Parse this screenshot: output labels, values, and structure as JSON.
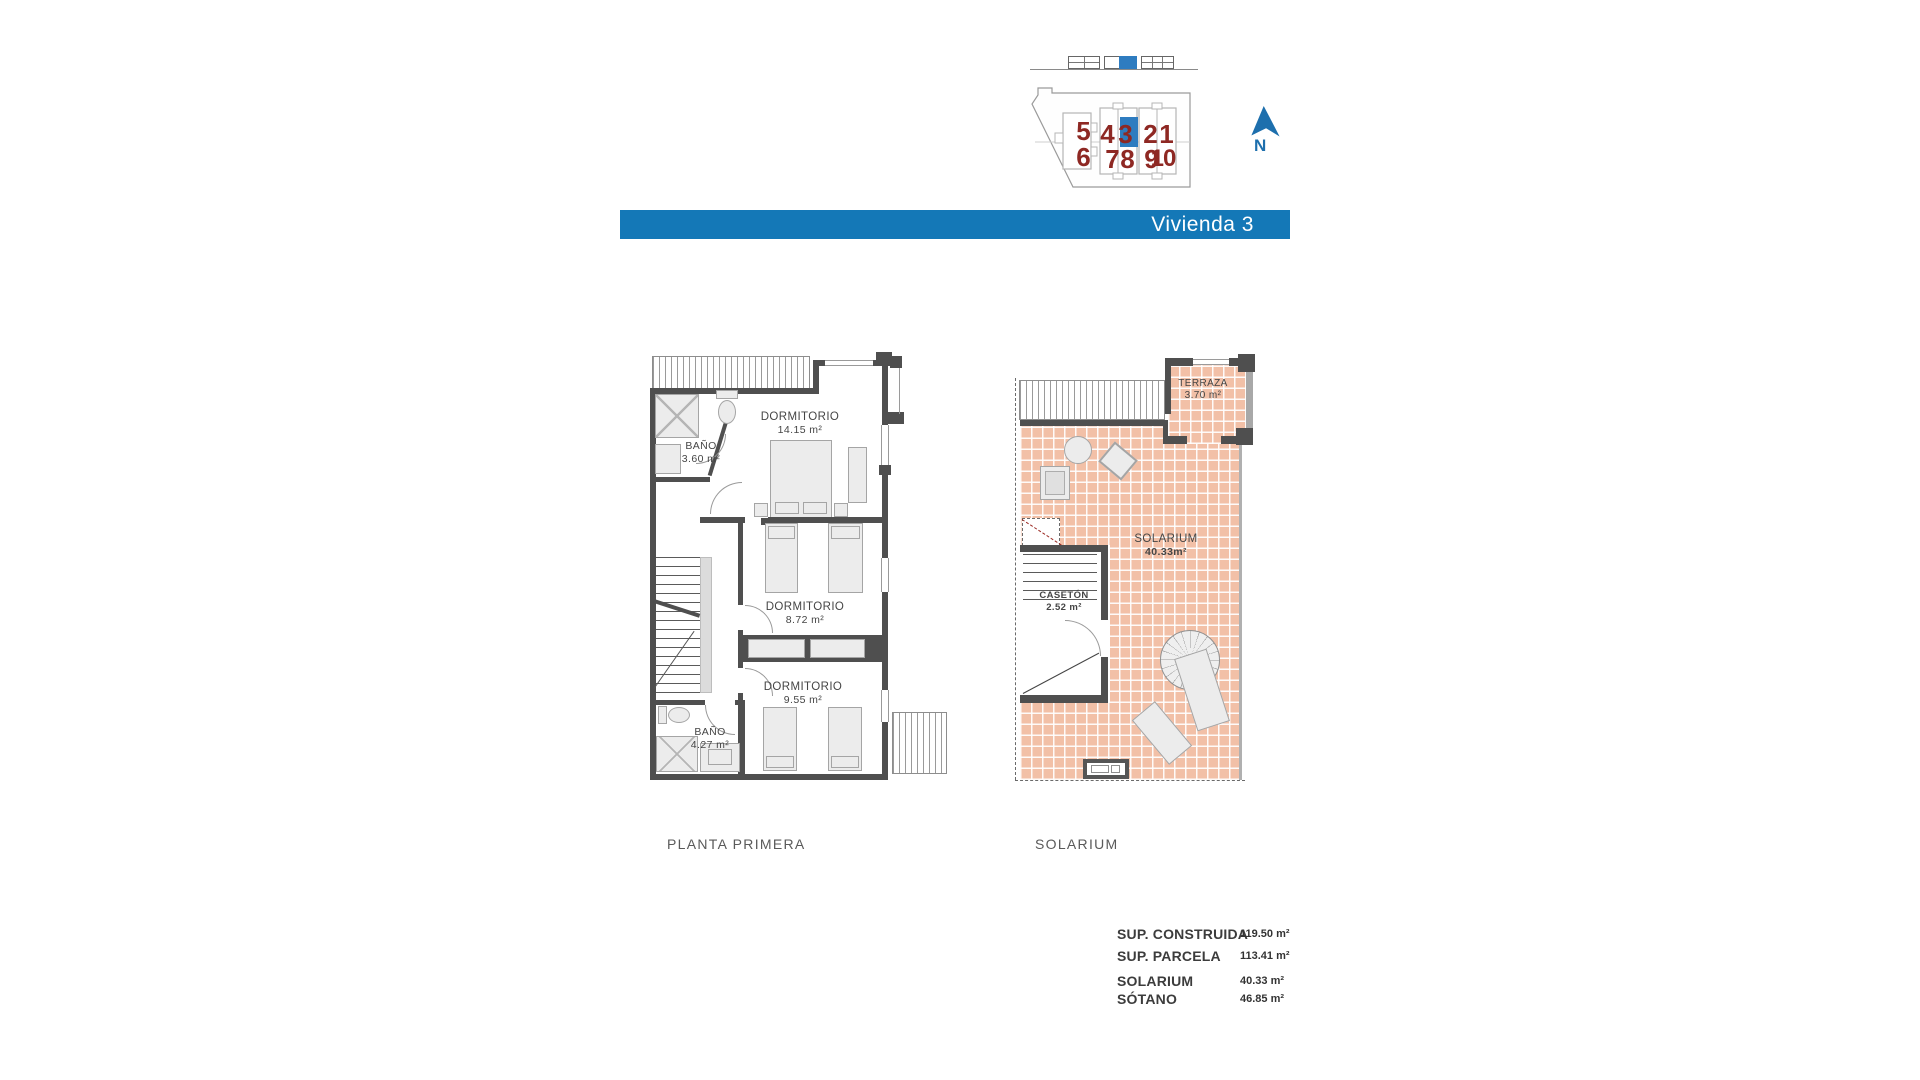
{
  "banner": {
    "title": "Vivienda 3"
  },
  "site_plan": {
    "highlighted_unit": "3",
    "north_label": "N",
    "units": {
      "u1": "1",
      "u2": "2",
      "u3": "3",
      "u4": "4",
      "u5": "5",
      "u6": "6",
      "u7": "7",
      "u8": "8",
      "u9": "9",
      "u10": "10"
    }
  },
  "plans": [
    {
      "title": "PLANTA PRIMERA",
      "rooms": [
        {
          "name": "BAÑO",
          "area": "3.60 m²"
        },
        {
          "name": "DORMITORIO",
          "area": "14.15 m²"
        },
        {
          "name": "DORMITORIO",
          "area": "8.72 m²"
        },
        {
          "name": "DORMITORIO",
          "area": "9.55 m²"
        },
        {
          "name": "BAÑO",
          "area": "4.27 m²"
        }
      ]
    },
    {
      "title": "SOLARIUM",
      "rooms": [
        {
          "name": "TERRAZA",
          "area": "3.70 m²"
        },
        {
          "name": "SOLARIUM",
          "area": "40.33m²"
        },
        {
          "name": "CASETÓN",
          "area": "2.52 m²"
        }
      ]
    }
  ],
  "summary": {
    "rows": [
      {
        "label": "SUP. CONSTRUIDA",
        "value": "119.50 m²"
      },
      {
        "label": "SUP. PARCELA",
        "value": "113.41 m²"
      },
      {
        "label": "SOLARIUM",
        "value": "40.33 m²"
      },
      {
        "label": "SÓTANO",
        "value": "46.85 m²"
      }
    ]
  },
  "colors": {
    "banner_blue": "#1478b7",
    "plot_number_red": "#8e2823",
    "highlight_blue": "#2e7cc0",
    "tile_pink": "#f2c0a7",
    "wall_dark": "#4f4f4f",
    "north_blue": "#1d6fad"
  }
}
